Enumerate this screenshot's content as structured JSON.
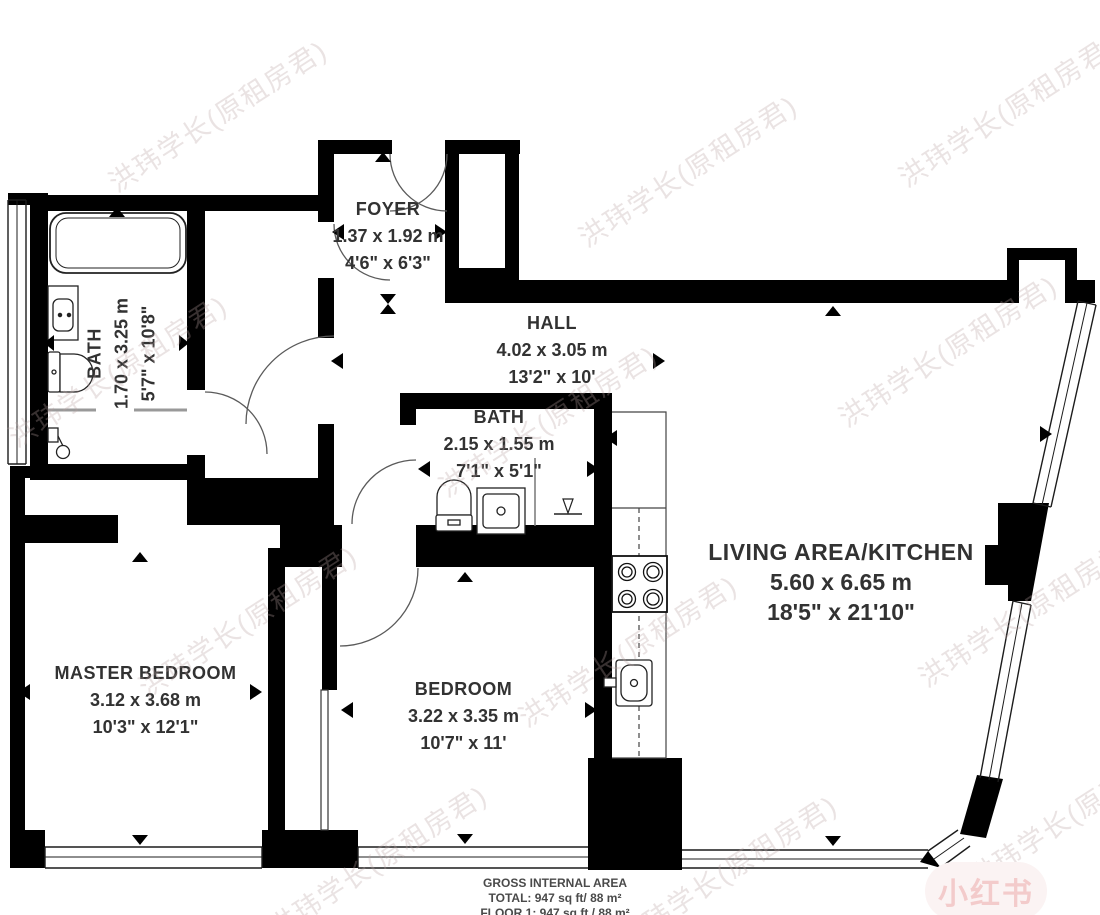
{
  "title": "apartment-floor-plan",
  "rooms": {
    "foyer": {
      "name": "FOYER",
      "metric": "1.37 x 1.92 m",
      "imperial": "4'6\" x 6'3\""
    },
    "hall": {
      "name": "HALL",
      "metric": "4.02 x 3.05 m",
      "imperial": "13'2\" x 10'"
    },
    "bath_left": {
      "name": "BATH",
      "metric": "1.70 x 3.25 m",
      "imperial": "5'7\" x 10'8\""
    },
    "bath_middle": {
      "name": "BATH",
      "metric": "2.15 x 1.55 m",
      "imperial": "7'1\" x 5'1\""
    },
    "master_bedroom": {
      "name": "MASTER BEDROOM",
      "metric": "3.12 x 3.68 m",
      "imperial": "10'3\" x 12'1\""
    },
    "bedroom": {
      "name": "BEDROOM",
      "metric": "3.22 x 3.35 m",
      "imperial": "10'7\" x 11'"
    },
    "living_kitchen": {
      "name": "LIVING AREA/KITCHEN",
      "metric": "5.60 x 6.65 m",
      "imperial": "18'5\" x 21'10\""
    }
  },
  "footer": {
    "line1": "GROSS INTERNAL AREA",
    "line2": "TOTAL: 947 sq ft/ 88 m²",
    "line3": "FLOOR 1: 947 sq ft / 88 m²"
  },
  "watermark": {
    "text": "洪玮学长(原租房君)",
    "badge": "小红书"
  },
  "colors": {
    "wall": "#000000",
    "label": "#323232",
    "watermark": "#baa3a3",
    "badge_pink": "#e48282",
    "screen_gray": "#999999"
  }
}
